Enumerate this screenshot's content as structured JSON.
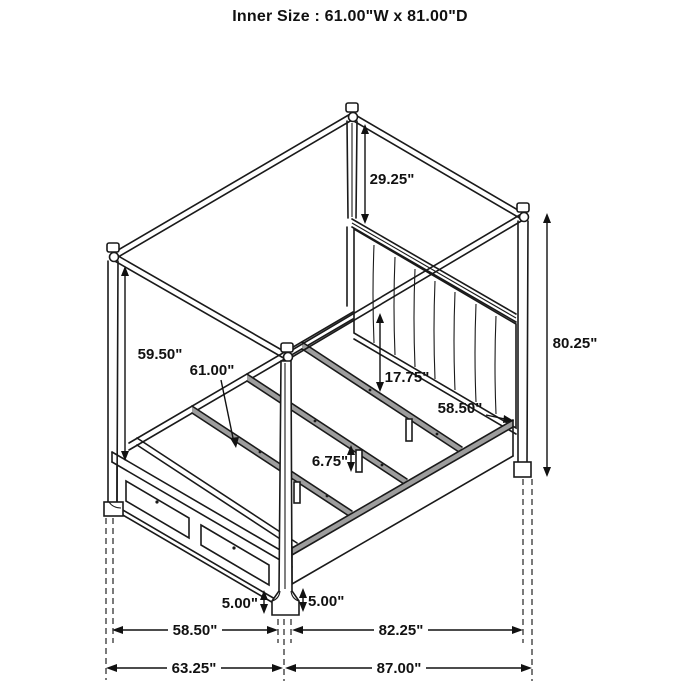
{
  "title": "Inner Size : 61.00\"W x 81.00\"D",
  "diagram": {
    "subject": "canopy bed with footboard storage drawers",
    "colors": {
      "line": "#1a1a1a",
      "shade": "#9d9d9d",
      "background": "#ffffff"
    },
    "annotations": {
      "canopy_to_headboard": "29.25\"",
      "overall_height": "80.25\"",
      "under_canopy_height": "59.50\"",
      "inner_width": "61.00\"",
      "headboard_panel_height": "17.75\"",
      "deck_width": "58.50\"",
      "slat_leg_height": "6.75\"",
      "clearance_left": "5.00\"",
      "clearance_right": "5.00\"",
      "footboard_width": "58.50\"",
      "side_rail_length": "82.25\"",
      "overall_width": "63.25\"",
      "overall_depth": "87.00\""
    }
  }
}
